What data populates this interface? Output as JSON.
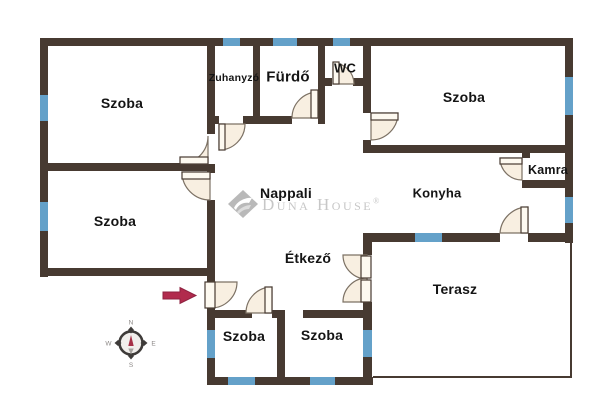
{
  "plan": {
    "type": "floor-plan",
    "rooms": [
      {
        "id": "szoba-top-left",
        "name": "Szoba"
      },
      {
        "id": "szoba-mid-left",
        "name": "Szoba"
      },
      {
        "id": "zuhanyzo",
        "name": "Zuhanyzó"
      },
      {
        "id": "furdo",
        "name": "Fürdő"
      },
      {
        "id": "wc",
        "name": "WC"
      },
      {
        "id": "szoba-top-right",
        "name": "Szoba"
      },
      {
        "id": "kamra",
        "name": "Kamra"
      },
      {
        "id": "nappali",
        "name": "Nappali"
      },
      {
        "id": "konyha",
        "name": "Konyha"
      },
      {
        "id": "etkezo",
        "name": "Étkező"
      },
      {
        "id": "terasz",
        "name": "Terasz"
      },
      {
        "id": "szoba-bottom-left",
        "name": "Szoba"
      },
      {
        "id": "szoba-bottom-mid",
        "name": "Szoba"
      }
    ]
  },
  "watermark": {
    "brand": "Duna House",
    "registered": "®"
  },
  "compass": {
    "n": "N",
    "e": "E",
    "s": "S",
    "w": "W"
  },
  "colors": {
    "wall": "#473a31",
    "window": "#64a1c9",
    "door_fill": "#f8efe1",
    "door_line": "#7c7164",
    "entry_arrow": "#b12b4d",
    "label": "#141414",
    "watermark": "#c7c7c7"
  }
}
